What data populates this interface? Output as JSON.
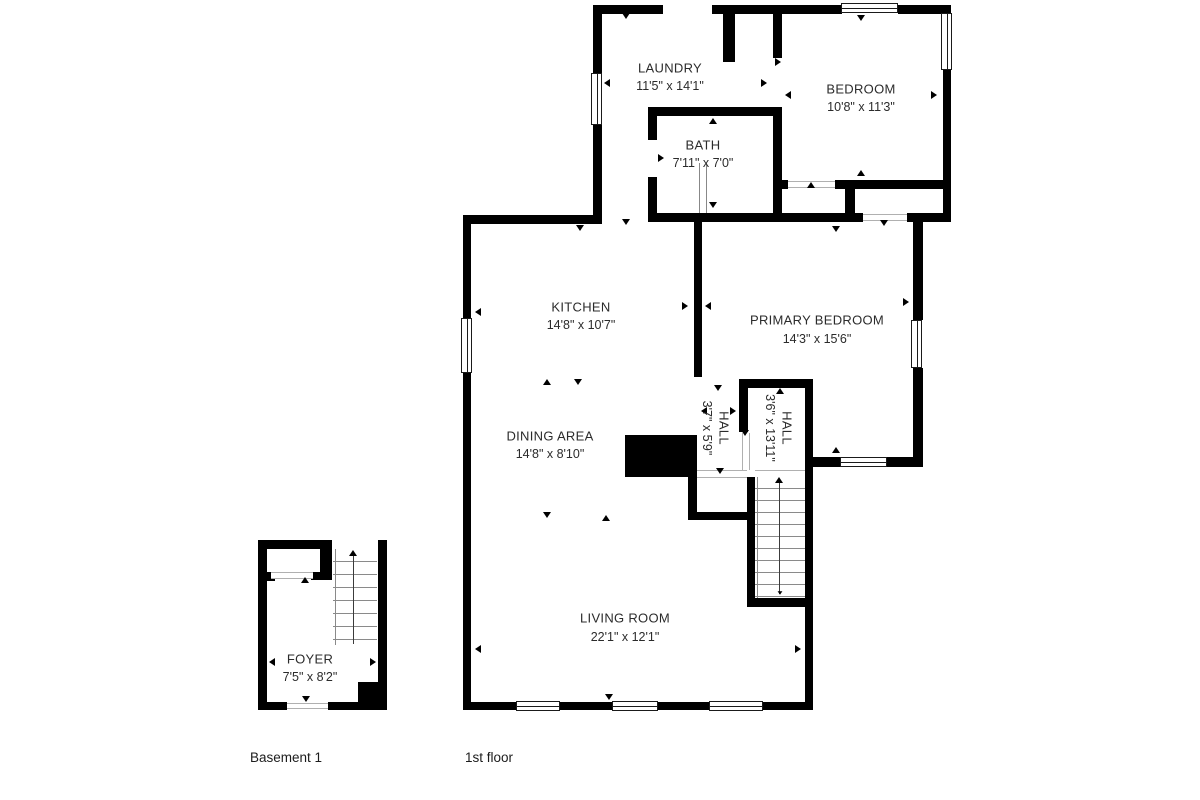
{
  "colors": {
    "wall": "#000000",
    "text": "#2b2b2b",
    "stair_line": "#8a8a8a",
    "background": "#ffffff"
  },
  "floors": {
    "first": {
      "caption": "1st floor",
      "rooms": {
        "laundry": {
          "name": "LAUNDRY",
          "dims": "11'5\" x 14'1\""
        },
        "bedroom": {
          "name": "BEDROOM",
          "dims": "10'8\" x 11'3\""
        },
        "bath": {
          "name": "BATH",
          "dims": "7'11\" x 7'0\""
        },
        "kitchen": {
          "name": "KITCHEN",
          "dims": "14'8\" x 10'7\""
        },
        "primary": {
          "name": "PRIMARY BEDROOM",
          "dims": "14'3\" x 15'6\""
        },
        "dining": {
          "name": "DINING AREA",
          "dims": "14'8\" x 8'10\""
        },
        "hall1": {
          "name": "HALL",
          "dims": "3'7\" x 5'9\""
        },
        "hall2": {
          "name": "HALL",
          "dims": "3'6\" x 13'11\""
        },
        "living": {
          "name": "LIVING ROOM",
          "dims": "22'1\" x 12'1\""
        }
      }
    },
    "basement": {
      "caption": "Basement 1",
      "rooms": {
        "foyer": {
          "name": "FOYER",
          "dims": "7'5\" x 8'2\""
        }
      }
    }
  }
}
